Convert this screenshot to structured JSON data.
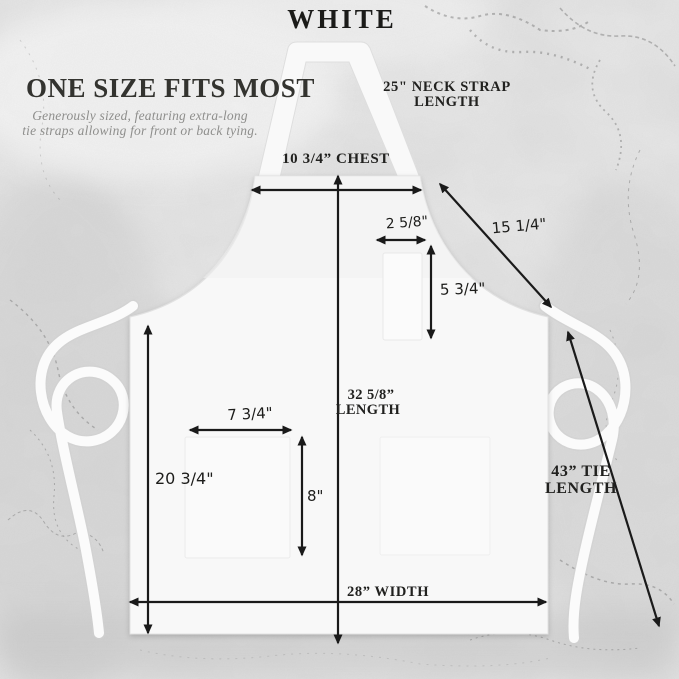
{
  "product": {
    "color_name": "WHITE",
    "headline": "ONE SIZE FITS MOST",
    "subtitle_line1": "Generously sized, featuring extra-long",
    "subtitle_line2": "tie straps allowing for front or back tying."
  },
  "measurements": {
    "neck_strap": {
      "line1": "25\" NECK STRAP",
      "line2": "LENGTH"
    },
    "chest": "10 3/4” CHEST",
    "bib_side_diagonal": "15 1/4\"",
    "pen_pocket_width": "2 5/8\"",
    "pen_pocket_height": "5 3/4\"",
    "length_line1": "32 5/8”",
    "length_line2": "LENGTH",
    "front_pocket_width": "7 3/4\"",
    "side_height": "20 3/4\"",
    "front_pocket_height": "8\"",
    "tie_line1": "43” TIE",
    "tie_line2": "LENGTH",
    "width": "28” WIDTH"
  },
  "colors": {
    "background_marble": "#e9e9e9",
    "apron_fabric": "#f8f8f8",
    "dimension_arrows": "#1a1a1a",
    "subtitle_text": "#8e8e8c"
  }
}
